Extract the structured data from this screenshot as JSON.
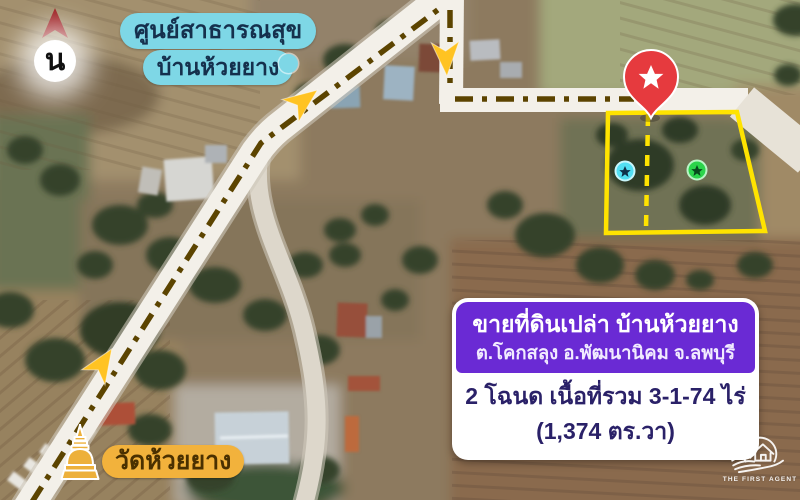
{
  "compass": {
    "label": "น",
    "arrow_color": "#9b1b1e"
  },
  "health_center_label": {
    "line1": "ศูนย์สาธารณสุข",
    "line2": "บ้านห้วยยาง",
    "bg_color": "#7ed7e6",
    "text_color": "#15304d"
  },
  "temple_label": {
    "text": "วัดห้วยยาง",
    "bg_color": "#f2b23c",
    "text_color": "#4a3000",
    "icon": "pagoda-icon"
  },
  "plot": {
    "outline_color": "#ffe300",
    "divider_style": "dashed",
    "pin": {
      "icon": "star",
      "color": "#e63a3e"
    },
    "markers": [
      {
        "icon": "star",
        "color": "#52dff2"
      },
      {
        "icon": "star",
        "color": "#2bd44b"
      }
    ]
  },
  "route": {
    "style": "dash-dot",
    "line_color": "#5c4400",
    "arrow_color": "#ffc322",
    "arrow_count": 3
  },
  "info_card": {
    "title": "ขายที่ดินเปล่า บ้านห้วยยาง",
    "subtitle": "ต.โคกสลุง อ.พัฒนานิคม จ.ลพบุรี",
    "area_line1": "2 โฉนด เนื้อที่รวม 3-1-74 ไร่",
    "area_line2": "(1,374 ตร.วา)",
    "header_bg": "#6a2ad4",
    "body_text_color": "#2a2168"
  },
  "logo": {
    "text": "THE FIRST AGENT"
  }
}
